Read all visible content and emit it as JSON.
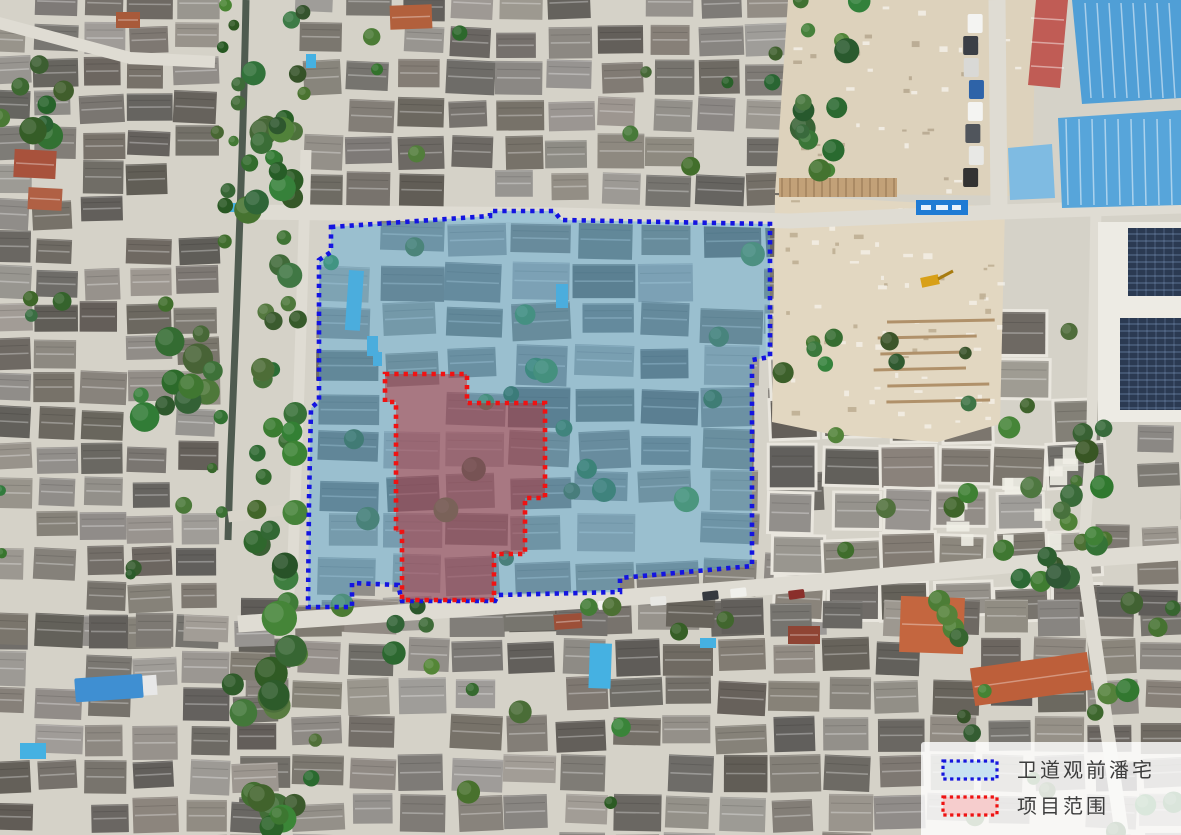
{
  "legend": {
    "items": [
      {
        "label": "卫道观前潘宅",
        "swatch_fill": "#c8e2f1",
        "swatch_stroke": "#1616dd"
      },
      {
        "label": "项目范围",
        "swatch_fill": "#f6cdcd",
        "swatch_stroke": "#ee1212"
      }
    ]
  },
  "overlays": {
    "heritage_area": {
      "label": "卫道观前潘宅",
      "fill": "rgba(82,168,214,0.45)",
      "stroke": "#1414e0",
      "points": "331,227 490,216 490,211 554,211 561,220 770,224 770,357 752,360 752,566 620,578 620,592 498,595 495,601 402,601 398,585 352,583 352,607 308,607 309,500 311,408 319,401 319,260 331,252"
    },
    "project_area": {
      "label": "项目范围",
      "fill": "rgba(185,40,45,0.47)",
      "stroke": "#f01212",
      "points": "385,374 467,374 467,403 545,403 545,498 525,498 525,554 494,554 494,600 402,600 402,532 396,532 396,402 385,402"
    }
  }
}
